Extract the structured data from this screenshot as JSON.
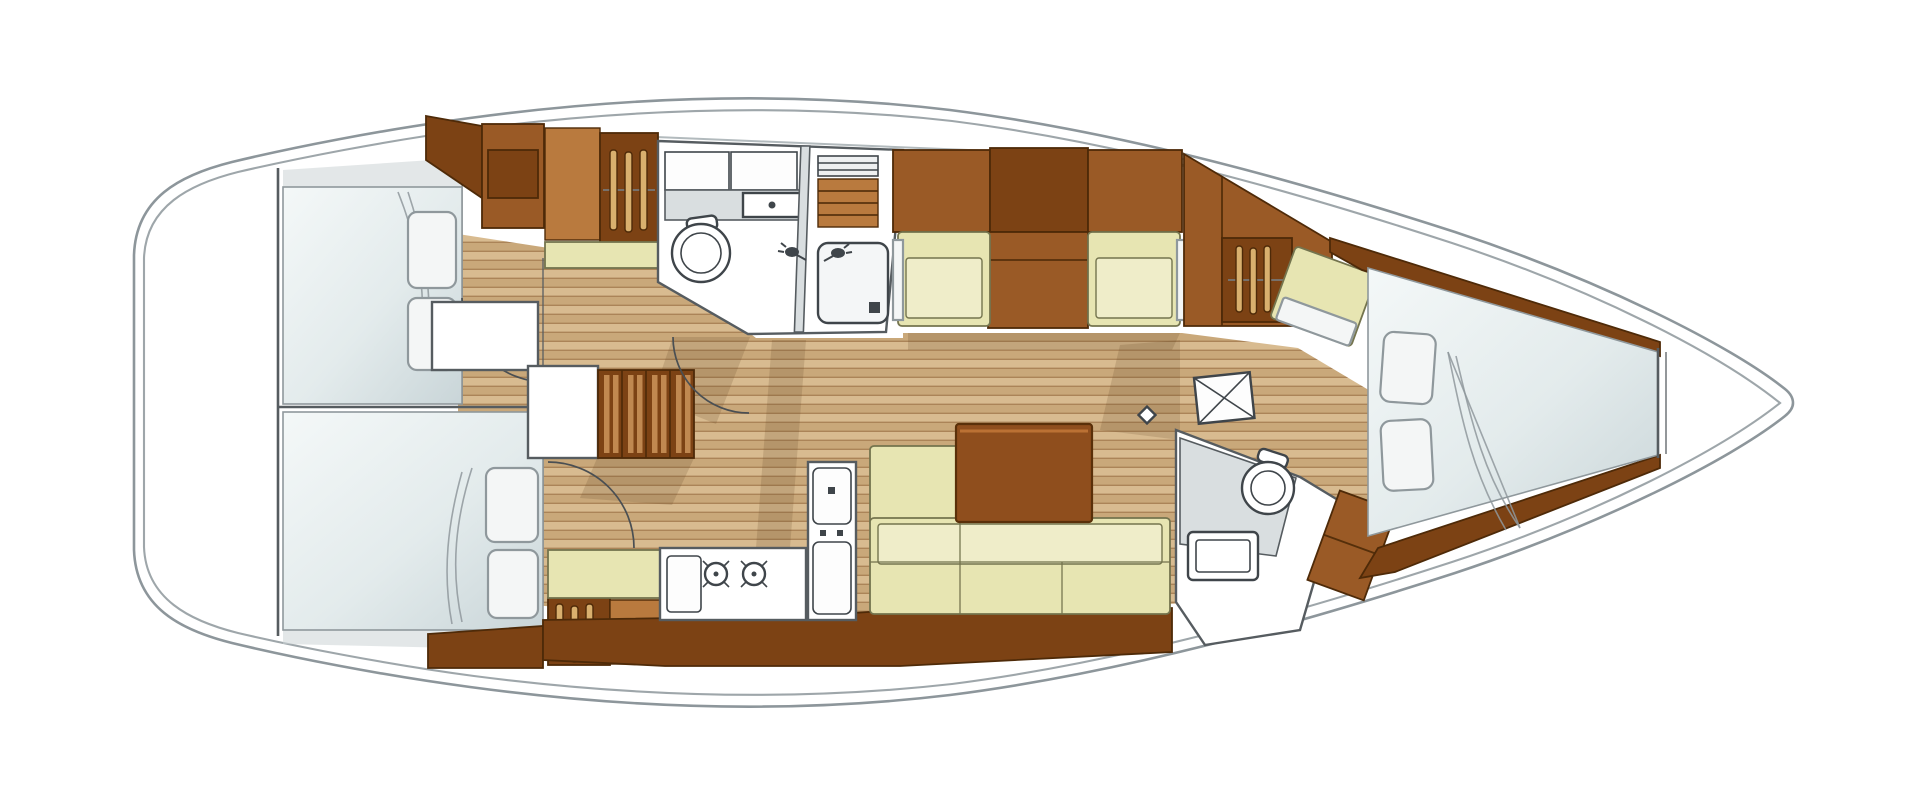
{
  "meta": {
    "kind": "sailing-yacht-interior-floor-plan",
    "view": "top-down",
    "bow_direction": "right"
  },
  "colors": {
    "hull_line": "#8d969b",
    "trunk_line": "#aab2b6",
    "wall_line": "#565c60",
    "wall_fill": "#d9dee0",
    "shade_gray": "#ccd3d6",
    "floor_a": "#d8bb90",
    "floor_b": "#c9a87a",
    "floor_gap": "#ab8458",
    "wood_dark": "#7c4214",
    "wood_mid": "#9a5a26",
    "wood_light": "#b97a3e",
    "wood_panel_line": "#4e2a08",
    "cushion": "#e7e5b2",
    "cushion_light": "#efedc9",
    "cushion_line": "#74744e",
    "bed_light": "#f1f5f5",
    "bed_shade": "#ccd7d9",
    "pillow": "#f4f6f6",
    "pillow_line": "#8f989c",
    "fixture_line": "#3f454a",
    "door_line": "#4a4f53",
    "shadow": "rgba(96,64,32,0.18)",
    "table_top": "#8f4e1d",
    "table_line": "#5a3009",
    "table_hi": "#bb7134",
    "step_slat": "#c08850",
    "hanger_fill": "#d9b06e"
  },
  "rooms": [
    {
      "id": "stern-lazarette"
    },
    {
      "id": "aft-cabin-port",
      "features": [
        "double-berth",
        "pillows",
        "hanging-locker",
        "shelf"
      ]
    },
    {
      "id": "aft-cabin-starboard",
      "features": [
        "double-berth",
        "pillows",
        "hanging-locker",
        "bench"
      ]
    },
    {
      "id": "aft-head",
      "features": [
        "toilet",
        "washbasin",
        "counter",
        "lockers",
        "shower-stall",
        "teak-grating",
        "shower-tray"
      ]
    },
    {
      "id": "companionway",
      "features": [
        "steps",
        "landing"
      ]
    },
    {
      "id": "galley",
      "features": [
        "twin-sinks",
        "counter",
        "fridge-column"
      ]
    },
    {
      "id": "salon",
      "features": [
        "l-settee",
        "table",
        "facing-seats",
        "cabinet",
        "mast-step"
      ]
    },
    {
      "id": "forward-head",
      "features": [
        "toilet",
        "washbasin",
        "counter",
        "folding-door"
      ]
    },
    {
      "id": "forward-cabin",
      "features": [
        "v-berth",
        "pillows",
        "hanging-locker",
        "seat"
      ]
    },
    {
      "id": "anchor-locker"
    }
  ],
  "icons": [
    "hanger-icon",
    "toilet-icon",
    "washbasin-icon",
    "sink-faucet-icon",
    "shower-head-icon",
    "drain-icon",
    "door-swing-icon",
    "folding-door-icon",
    "mast-step-icon",
    "latch-icon"
  ]
}
